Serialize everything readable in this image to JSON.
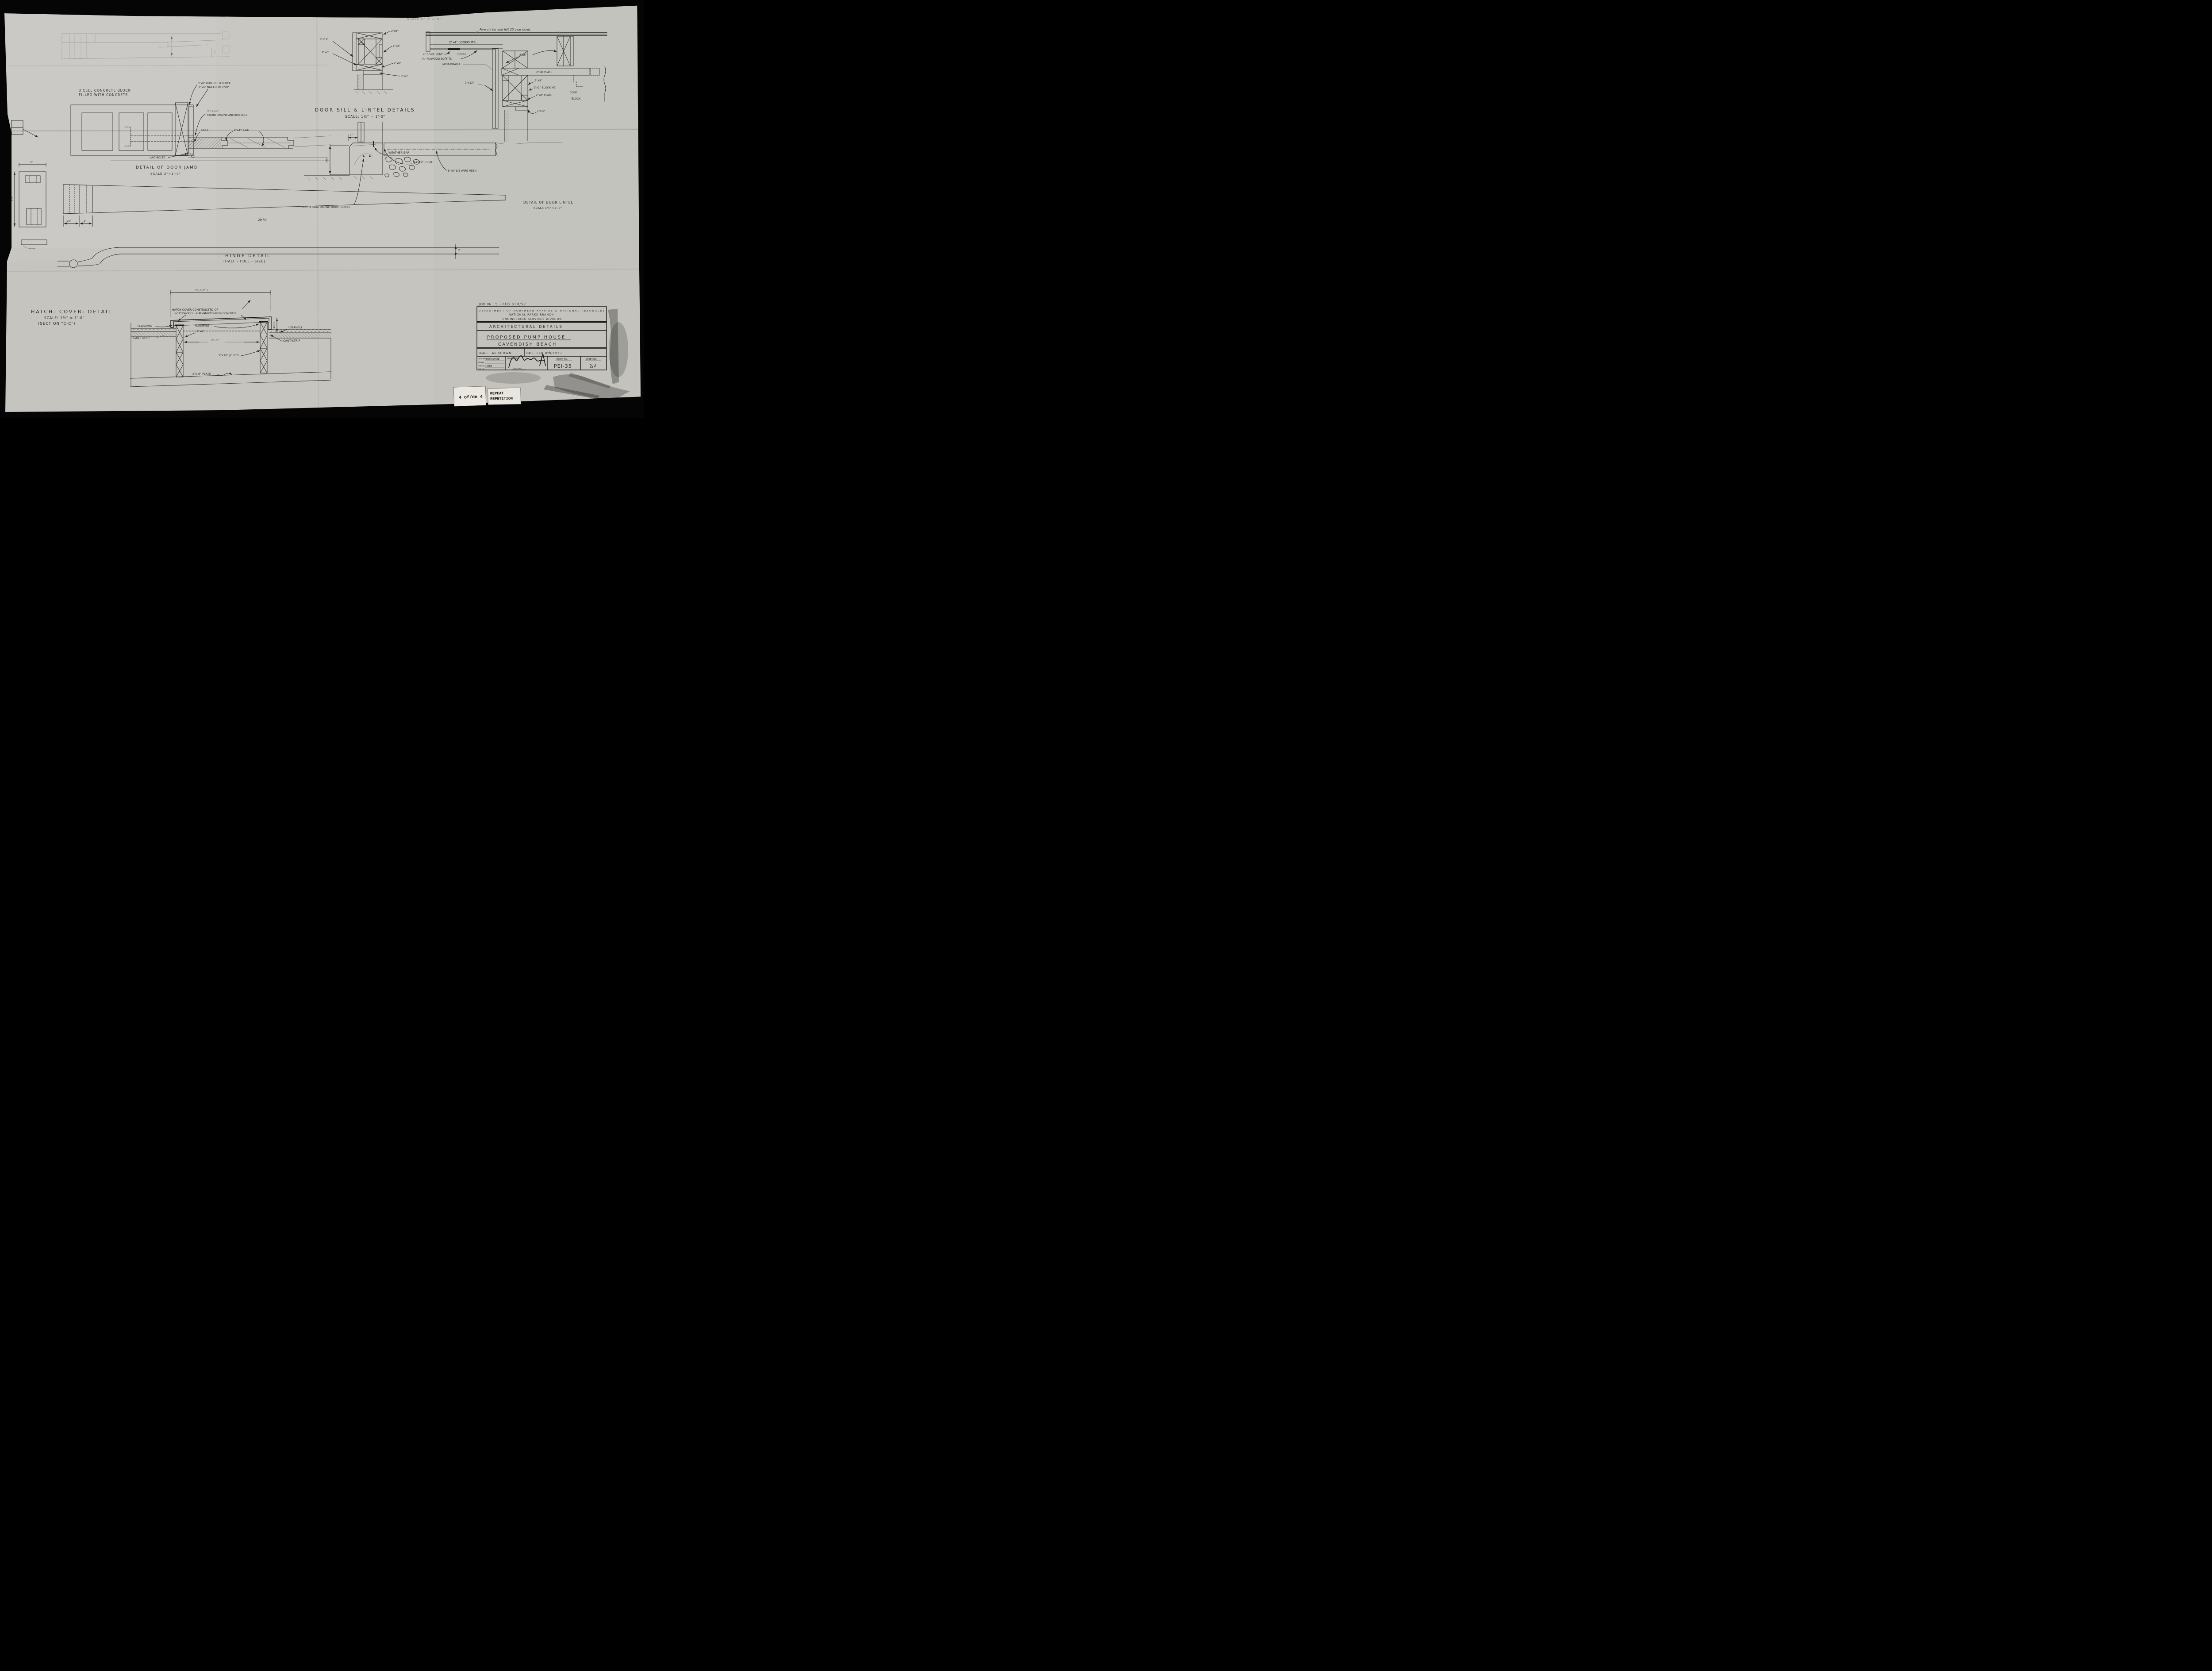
{
  "colors": {
    "paper": "#c8c7c2",
    "ink": "#2b2923",
    "faint": "#75736a",
    "badge_bg": "#ebe8e1",
    "black": "#060606"
  },
  "page": {
    "top_cut_scale": "SCALE ¾\" = 1'-0\"",
    "badge_page": "4 of/de 4",
    "badge_repeat1": "REPEAT",
    "badge_repeat2": "REPETITION"
  },
  "margin_left": {
    "dim_2": "2\"",
    "dim_2_34": "2¾\""
  },
  "faint_plan": {
    "dim_10": "10\"",
    "dim_2_14": "2¼\""
  },
  "block_note": {
    "l1": "3 CELL CONCRETE BLOCK",
    "l2": "FILLED WITH CONCRETE"
  },
  "jamb": {
    "bolt_note1": "3\"x8\" BOLTED TO BLOCK",
    "bolt_note2": "1\"x6\" NAILED TO 2\"x8\"",
    "anchor1": "½\" x 10\"",
    "anchor2": "COUNTERSUNK ANCHOR BOLT",
    "stile": "STILE",
    "tg": "1\"x4\" T.&G",
    "lag": "LAG BOLTS",
    "title": "DETAIL OF DOOR JAMB",
    "scale": "SCALE 3\"=1'-0\""
  },
  "sill": {
    "title": "DOOR SILL & LINTEL DETAILS",
    "scale": "SCALE: 1½\" = 1'-0\"",
    "weather": "WEATHER BAR",
    "mastic": "MASTIC JOINT",
    "dim4": "4\"",
    "dim7": "7½\"",
    "rods": "2-½\" ø REINFORCING RODS (CONT.)",
    "mesh": "6\"x6\" 8/8 WIRE MESH"
  },
  "lintel": {
    "x112": "1\"x12\"",
    "x22": "2\"x2\"",
    "x28a": "2\"x8\"",
    "x18": "1\"x8\"",
    "x28b": "2\"x8\"",
    "x36": "3\"x6\""
  },
  "eave": {
    "felt": "Five ply tar and felt 20 year bond.",
    "lookouts": "2\"x4\" LOOKOUTS",
    "vent": "4\" CONT. VENT",
    "screen": "SCREEN",
    "soffits": "¼\" PLYWOOD SOFFITS",
    "facia": "FACIA BOARD",
    "x26": "2\"x6\"",
    "x112": "1\"x12\"",
    "plate_top": "2\"x8 PLATE",
    "x18": "1\"x8\"",
    "blocking": "1\"x1\" BLOCKING",
    "plate_low": "2\"x8\" PLATE",
    "conc1": "CONC.",
    "conc2": "BLOCK",
    "x16": "1\"x 6\""
  },
  "lintel_detail": {
    "title": "DETAIL OF DOOR LINTEL",
    "scale": "SCALE 1½\"=1'-0\""
  },
  "hinge": {
    "dim29": "29 ¾\"",
    "dim138": "1⅜\"",
    "dim1": "1\"",
    "dim38": "⅜\"",
    "title": "HINGE DETAIL",
    "sub": "(HALF - FULL - SIZE)"
  },
  "hatch": {
    "title": "HATCH- COVER- DETAIL",
    "scale": "SCALE: 1½\" = 1'-0\"",
    "section": "(SECTION \"C-C\")",
    "dimw": "2'- 8½\" ±",
    "note1": "HATCH COVER CONSTRUCTED-OF",
    "note2": "¾\" PLYWOOD. - GALVANIZED-IRON COVERED",
    "flash_l": "FLASHING",
    "flash_r": "FLASHING",
    "x28": "2\"x8\"",
    "dim28": "2'- 8\"",
    "dim45": "4½\"±",
    "gravel": "(GRAVEL)",
    "cant_l": "CANT STRIP",
    "cant_r": "CANT·STRIP",
    "joists": "2\"x10\" JOISTS",
    "plate": "2\"x 8\" PLATE"
  },
  "titleblock": {
    "job": "JOB № 15 - FEB 8TH/57",
    "dept1": "DEPARTMENT OF NORTHERN AFFAIRS & NATIONAL RESOURCES",
    "dept2": "NATIONAL PARKS BRANCH",
    "dept3": "ENGINEERING SERVICES DIVISION",
    "arch": "ARCHITECTURAL DETAILS",
    "proj1": "PROPOSED PUMP HOUSE",
    "proj2": "CAVENDISH BEACH",
    "scale_l": "SCALE:",
    "scale_v": "AS SHOWN",
    "date_l": "DATE",
    "date_v": "FEB 8th/1957",
    "designed_l": "DESIGNED",
    "designed_v": "MORCOMBE",
    "drawn_l": "DRAWN",
    "drawn_v": "..",
    "checked_l": "CHECKED",
    "checked_v": "GIBB",
    "file_l": "FILE NO.",
    "approved_l": "APPROVED",
    "chief": "CHIEF ENG.",
    "index_l": "INDEX NO.",
    "index_v": "PEI-35",
    "sheet_l": "SHEET NO.",
    "sheet_v": "2/2"
  }
}
